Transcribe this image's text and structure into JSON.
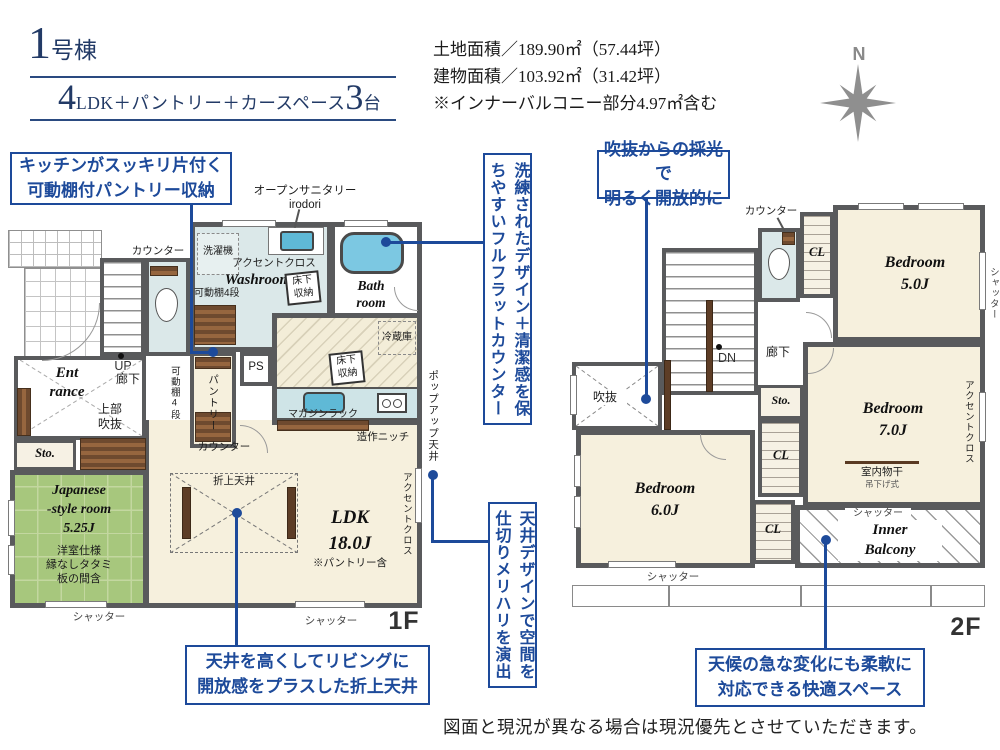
{
  "colors": {
    "accent_blue": "#1d4a9a",
    "title_navy": "#223a66",
    "wall_gray": "#595a5c",
    "tatami_green": "#a7c77d",
    "water_blue": "#6fc3dd"
  },
  "header": {
    "unit_number": "1",
    "unit_suffix": "号棟",
    "plan_big1": "4",
    "plan_text": "LDK＋パントリー＋カースペース",
    "plan_big2": "3",
    "plan_tail": "台",
    "area_line1": "土地面積／189.90㎡（57.44坪）",
    "area_line2": "建物面積／103.92㎡（31.42坪）",
    "area_line3": "※インナーバルコニー部分4.97㎡含む",
    "compass_north": "N"
  },
  "callouts": {
    "pantry_storage": "キッチンがスッキリ片付く\n可動棚付パントリー収納",
    "flat_counter": "洗練されたデザイン＋清潔感を保ちやすいフルフラットカウンター",
    "void_light": "吹抜からの採光で\n明るく開放的に",
    "ceiling_design": "天井デザインで空間を仕切りメリハリを演出",
    "folded_ceiling": "天井を高くしてリビングに\n開放感をプラスした折上天井",
    "inner_balcony": "天候の急な変化にも柔軟に\n対応できる快適スペース"
  },
  "floor1": {
    "floor_label": "1F",
    "open_sanitary": "オープンサニタリー\nirodori",
    "washer": "洗濯機",
    "accent_cloth": "アクセントクロス",
    "washroom": "Washroom",
    "underfloor": "床下\n収納",
    "shelf4": "可動棚4段",
    "bathroom": "Bath\nroom",
    "counter": "カウンター",
    "up": "UP",
    "hallway": "廊下",
    "entrance": "Ent\nrance",
    "upper_void": "上部\n吹抜",
    "pantry": "パントリー",
    "ps": "PS",
    "storage": "Sto.",
    "fridge": "冷蔵庫",
    "magazine_rack": "マガジンラック",
    "niche": "造作ニッチ",
    "popup_ceiling": "ポップアップ天井",
    "folded_ceiling": "折上天井",
    "ldk": "LDK\n18.0J",
    "ldk_note": "※パントリー含",
    "japanese_room": "Japanese\n-style room\n5.25J",
    "japanese_note": "洋室仕様\n縁なしタタミ\n板の間含",
    "shutter": "シャッター"
  },
  "floor2": {
    "floor_label": "2F",
    "counter": "カウンター",
    "closet": "CL",
    "bedroom5": "Bedroom\n5.0J",
    "bedroom6": "Bedroom\n6.0J",
    "bedroom7": "Bedroom\n7.0J",
    "shutter": "シャッター",
    "down": "DN",
    "hallway": "廊下",
    "void": "吹抜",
    "storage": "Sto.",
    "indoor_drying": "室内物干",
    "hanging_type": "吊下げ式",
    "accent_cloth": "アクセントクロス",
    "inner_balcony": "Inner\nBalcony"
  },
  "footer": {
    "disclaimer": "図面と現況が異なる場合は現況優先とさせていただきます。"
  }
}
